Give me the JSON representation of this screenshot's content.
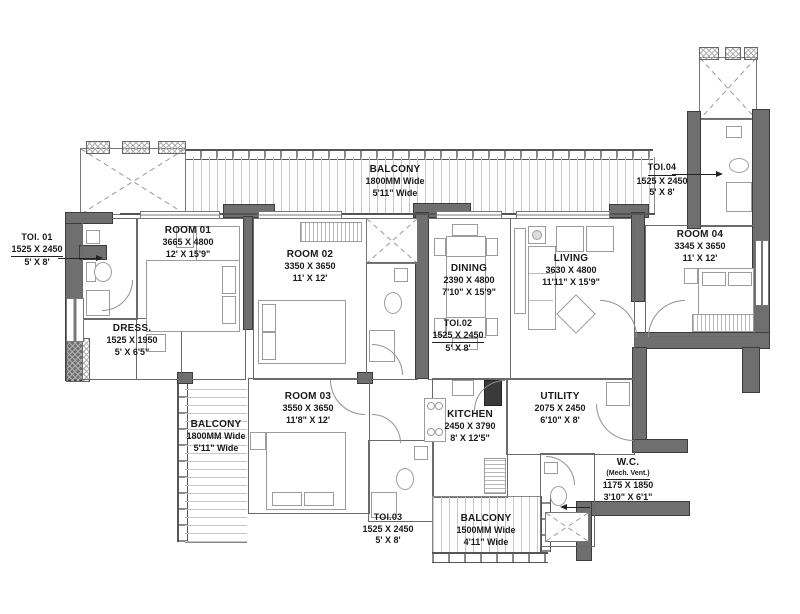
{
  "plan": {
    "colors": {
      "wall": "#6f6f6f",
      "line": "#5a5a5a",
      "text": "#1a1a1a",
      "hatch": "#c6c6c6",
      "bg": "#ffffff"
    },
    "rooms": [
      {
        "id": "balcony-top",
        "name": "BALCONY",
        "dim_mm": "1800MM Wide",
        "dim_ft": "5'11\" Wide"
      },
      {
        "id": "toi-01",
        "name": "TOI. 01",
        "dim_mm": "1525 X 2450",
        "dim_ft": "5' X 8'"
      },
      {
        "id": "room-01",
        "name": "ROOM 01",
        "dim_mm": "3665 X 4800",
        "dim_ft": "12' X 15'9\""
      },
      {
        "id": "dress",
        "name": "DRESS.",
        "dim_mm": "1525 X 1950",
        "dim_ft": "5' X 6'5\""
      },
      {
        "id": "room-02",
        "name": "ROOM 02",
        "dim_mm": "3350 X 3650",
        "dim_ft": "11' X 12'"
      },
      {
        "id": "toi-02",
        "name": "TOI.02",
        "dim_mm": "1525 X 2450",
        "dim_ft": "5' X 8'"
      },
      {
        "id": "dining",
        "name": "DINING",
        "dim_mm": "2390 X 4800",
        "dim_ft": "7'10\" X 15'9\""
      },
      {
        "id": "living",
        "name": "LIVING",
        "dim_mm": "3630 X 4800",
        "dim_ft": "11'11\" X 15'9\""
      },
      {
        "id": "toi-04",
        "name": "TOI.04",
        "dim_mm": "1525 X 2450",
        "dim_ft": "5' X 8'"
      },
      {
        "id": "room-04",
        "name": "ROOM 04",
        "dim_mm": "3345 X 3650",
        "dim_ft": "11' X 12'"
      },
      {
        "id": "balcony-left",
        "name": "BALCONY",
        "dim_mm": "1800MM Wide",
        "dim_ft": "5'11\" Wide"
      },
      {
        "id": "room-03",
        "name": "ROOM 03",
        "dim_mm": "3550 X 3650",
        "dim_ft": "11'8\" X 12'"
      },
      {
        "id": "toi-03",
        "name": "TOI.03",
        "dim_mm": "1525 X 2450",
        "dim_ft": "5' X 8'"
      },
      {
        "id": "kitchen",
        "name": "KITCHEN",
        "dim_mm": "2450 X 3790",
        "dim_ft": "8' X 12'5\""
      },
      {
        "id": "utility",
        "name": "UTILITY",
        "dim_mm": "2075 X 2450",
        "dim_ft": "6'10\" X 8'"
      },
      {
        "id": "wc",
        "name": "W.C.",
        "note": "(Mech. Vent.)",
        "dim_mm": "1175 X 1850",
        "dim_ft": "3'10\" X 6'1\""
      },
      {
        "id": "balcony-bottom",
        "name": "BALCONY",
        "dim_mm": "1500MM Wide",
        "dim_ft": "4'11\" Wide"
      }
    ]
  }
}
